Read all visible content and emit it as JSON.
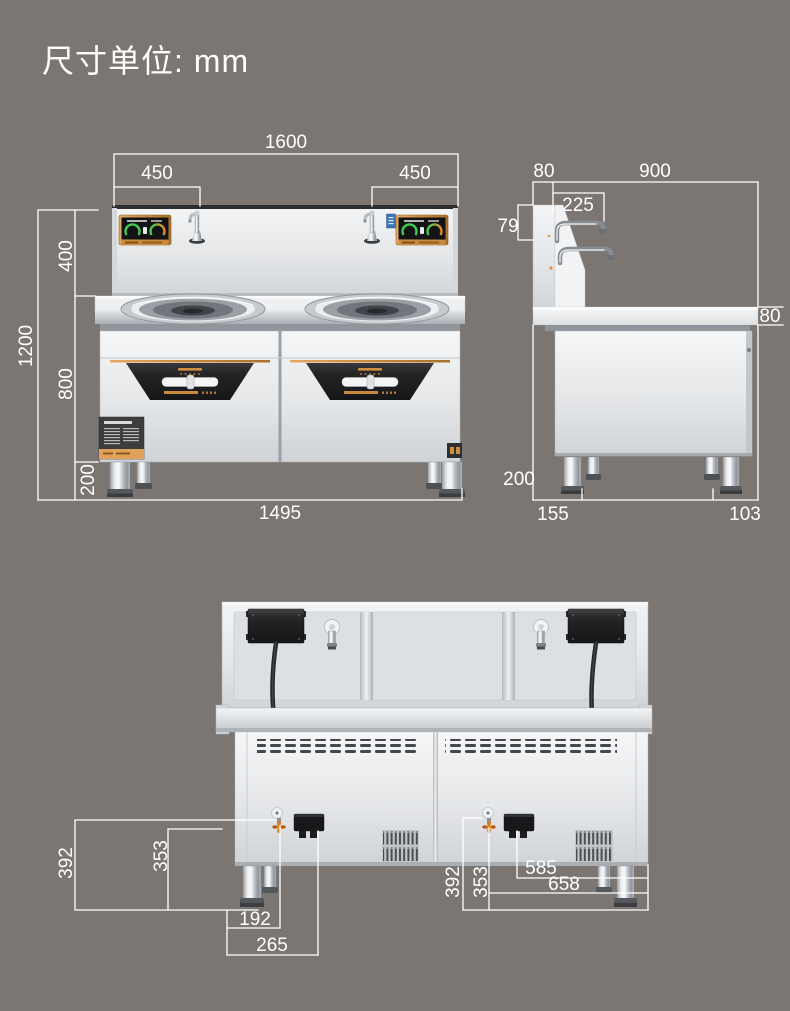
{
  "title": "尺寸单位: mm",
  "unit": "mm",
  "colors": {
    "background": "#7b7672",
    "dimension_lines": "#ffffff",
    "steel_light": "#eef0f2",
    "steel_mid": "#cfd3d6",
    "accent_orange": "#c98a3f",
    "display_green": "#3fc94f",
    "panel_dark": "#1c1c1e"
  },
  "views": {
    "front": {
      "dims": {
        "overall_width": "1600",
        "left_burner_offset": "450",
        "right_burner_offset": "450",
        "backsplash_height": "400",
        "body_height": "800",
        "total_height": "1200",
        "leg_height": "200",
        "base_width": "1495"
      }
    },
    "side": {
      "dims": {
        "backsplash_thickness": "80",
        "overall_depth": "900",
        "spout_reach": "225",
        "spout_height": "79",
        "countertop_thickness": "80",
        "leg_height": "200",
        "front_leg_inset": "155",
        "rear_leg_inset": "103"
      }
    },
    "rear": {
      "left": {
        "inlet_height": "392",
        "connector_height": "353",
        "inlet_offset": "192",
        "connector_offset": "265"
      },
      "right": {
        "inlet_height": "392",
        "connector_height": "353",
        "connector_offset": "585",
        "inlet_offset": "658"
      }
    }
  }
}
